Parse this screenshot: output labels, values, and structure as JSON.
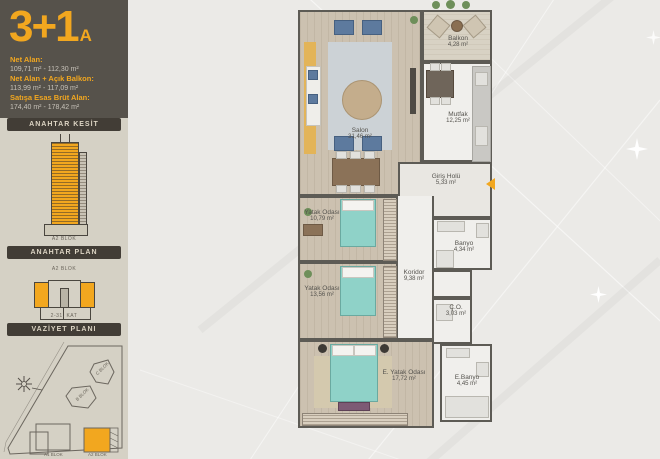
{
  "sidebar": {
    "title": "3+1",
    "title_variant": "A",
    "stats": [
      {
        "label": "Net Alan:",
        "value": "109,71 m² - 112,30 m²"
      },
      {
        "label": "Net Alan + Açık Balkon:",
        "value": "113,99 m² - 117,09 m²"
      },
      {
        "label": "Satışa Esas Brüt Alan:",
        "value": "174,40 m² - 178,42 m²"
      }
    ],
    "anahtar_kesit": {
      "header": "ANAHTAR KESİT",
      "block_label": "A2 BLOK"
    },
    "anahtar_plan": {
      "header": "ANAHTAR PLAN",
      "block_label": "A2 BLOK",
      "floor_label": "2-31. KAT"
    },
    "vaziyet_plani": {
      "header": "VAZİYET PLANI",
      "labels": {
        "c_blok": "C BLOK",
        "b_blok": "B BLOK",
        "a1_blok": "A1 BLOK",
        "a2_blok": "A2 BLOK"
      }
    },
    "colors": {
      "accent": "#F2A71F",
      "sidebar_bg": "#56524B",
      "bar_bg": "#423D36",
      "panel_bg": "#D5D1C5"
    }
  },
  "plan": {
    "rooms": [
      {
        "name": "Salon",
        "area": "31,46 m²"
      },
      {
        "name": "Balkon",
        "area": "4,28 m²"
      },
      {
        "name": "Mutfak",
        "area": "12,25 m²"
      },
      {
        "name": "Giriş Holü",
        "area": "5,33 m²"
      },
      {
        "name": "Yatak Odası",
        "area": "10,79 m²"
      },
      {
        "name": "Yatak Odası",
        "area": "13,56 m²"
      },
      {
        "name": "Koridor",
        "area": "9,38 m²"
      },
      {
        "name": "Banyo",
        "area": "4,34 m²"
      },
      {
        "name": "Ç.O.",
        "area": "3,03 m²"
      },
      {
        "name": "E. Yatak Odası",
        "area": "17,72 m²"
      },
      {
        "name": "E.Banyo",
        "area": "4,45 m²"
      }
    ],
    "colors": {
      "wall": "#5D5B55",
      "wood_floor": "#CCC1B0",
      "wet_floor": "#F0EFEC",
      "bed": "#8FD2C8"
    }
  }
}
